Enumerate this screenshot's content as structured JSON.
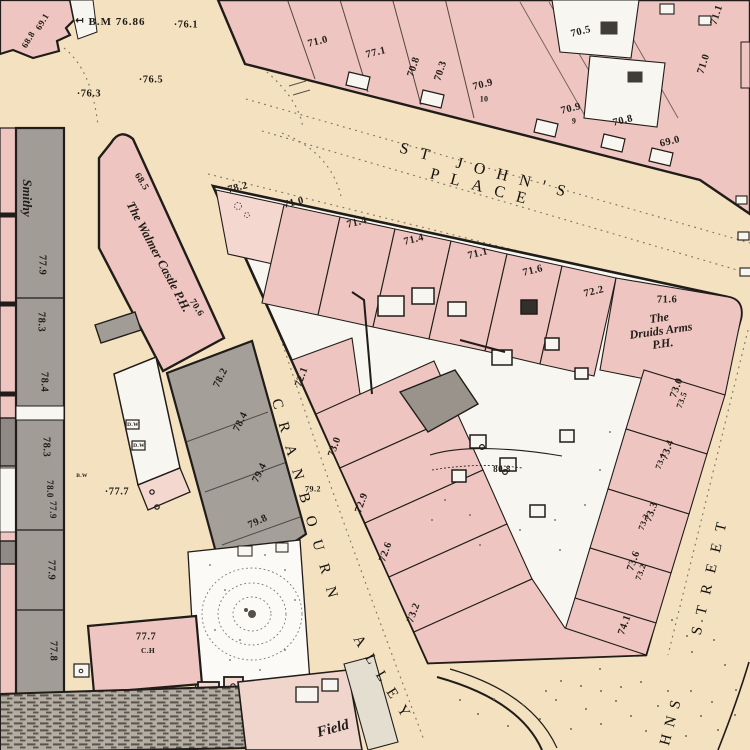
{
  "palette": {
    "street_tan": "#f3e1bf",
    "building_pink": "#eec5c0",
    "building_pink_light": "#f4d8d0",
    "yard_white": "#f8f6f0",
    "building_gray": "#a29c96",
    "building_gray_dark": "#8f8a85",
    "line_ink": "#201c19"
  },
  "streets": [
    {
      "t": "ST JOHN'S PLACE",
      "x": 486,
      "y": 180,
      "r": 15,
      "ls": 12,
      "n": "street-name-st-johns-place"
    },
    {
      "t": "CRANBOURN",
      "x": 306,
      "y": 505,
      "r": 74,
      "ls": 14,
      "s": 15,
      "n": "street-name-cranbourn"
    },
    {
      "t": "ALLEY",
      "x": 384,
      "y": 681,
      "r": 58,
      "ls": 11,
      "s": 15,
      "n": "street-name-alley"
    },
    {
      "t": "STREET",
      "x": 711,
      "y": 573,
      "r": -77,
      "ls": 12,
      "s": 15,
      "n": "street-name-street"
    },
    {
      "t": "HNS",
      "x": 672,
      "y": 719,
      "r": -75,
      "ls": 8,
      "s": 15,
      "n": "street-name-johns-partial"
    }
  ],
  "places": [
    {
      "t": "Smithy",
      "x": 27,
      "y": 198,
      "r": 90,
      "s": 13,
      "n": "place-name-smithy"
    },
    {
      "t": "The Walmer Castle P.H.",
      "x": 158,
      "y": 257,
      "r": 62,
      "s": 12.5,
      "n": "place-name-walmer-castle"
    },
    {
      "t": "The\nDruids Arms\nP.H.",
      "x": 661,
      "y": 331,
      "r": -8,
      "s": 12,
      "n": "place-name-druids-arms"
    },
    {
      "t": "Field",
      "x": 333,
      "y": 729,
      "r": -15,
      "s": 15,
      "n": "place-name-field"
    }
  ],
  "benchmarks": [
    {
      "t": "↤",
      "x": 80,
      "y": 22,
      "s": 10,
      "n": "benchmark-arrow"
    },
    {
      "t": "B.M 76.86",
      "x": 117,
      "y": 23,
      "n": "benchmark-value"
    }
  ],
  "spot_heights": [
    {
      "t": "69.1",
      "x": 43,
      "y": 22,
      "r": -60,
      "s": 9
    },
    {
      "t": "68.8",
      "x": 29,
      "y": 40,
      "r": -60,
      "s": 9
    },
    {
      "t": "·76.1",
      "x": 186,
      "y": 25
    },
    {
      "t": "·76.5",
      "x": 151,
      "y": 80
    },
    {
      "t": "·76.3",
      "x": 89,
      "y": 94
    },
    {
      "t": "71.0",
      "x": 318,
      "y": 42,
      "r": -14
    },
    {
      "t": "77.1",
      "x": 376,
      "y": 53,
      "r": -14
    },
    {
      "t": "70.8",
      "x": 414,
      "y": 67,
      "r": -72
    },
    {
      "t": "70.3",
      "x": 441,
      "y": 71,
      "r": -72
    },
    {
      "t": "70.9",
      "x": 483,
      "y": 85,
      "r": -14
    },
    {
      "t": "70.5",
      "x": 581,
      "y": 32,
      "r": -14
    },
    {
      "t": "70.9",
      "x": 571,
      "y": 109,
      "r": -14
    },
    {
      "t": "70.8",
      "x": 623,
      "y": 121,
      "r": -14
    },
    {
      "t": "69.0",
      "x": 670,
      "y": 142,
      "r": -14
    },
    {
      "t": "71.1",
      "x": 717,
      "y": 15,
      "r": -72
    },
    {
      "t": "71.0",
      "x": 704,
      "y": 64,
      "r": -72
    },
    {
      "t": "78.2",
      "x": 238,
      "y": 188,
      "r": -14
    },
    {
      "t": "71.0",
      "x": 294,
      "y": 203,
      "r": -14
    },
    {
      "t": "71.4",
      "x": 357,
      "y": 223,
      "r": -14
    },
    {
      "t": "71.4",
      "x": 414,
      "y": 240,
      "r": -14
    },
    {
      "t": "71.1",
      "x": 478,
      "y": 254,
      "r": -14
    },
    {
      "t": "71.6",
      "x": 533,
      "y": 271,
      "r": -14
    },
    {
      "t": "72.2",
      "x": 594,
      "y": 292,
      "r": -14
    },
    {
      "t": "71.6",
      "x": 667,
      "y": 300
    },
    {
      "t": "77.9",
      "x": 42,
      "y": 265,
      "r": 90
    },
    {
      "t": "78.3",
      "x": 41,
      "y": 322,
      "r": 90
    },
    {
      "t": "78.4",
      "x": 44,
      "y": 382,
      "r": 90
    },
    {
      "t": "78.3",
      "x": 46,
      "y": 447,
      "r": 90
    },
    {
      "t": "78.0",
      "x": 49,
      "y": 489,
      "r": 90,
      "s": 9
    },
    {
      "t": "77.9",
      "x": 52,
      "y": 510,
      "r": 90,
      "s": 9
    },
    {
      "t": "77.9",
      "x": 51,
      "y": 570,
      "r": 90
    },
    {
      "t": "77.8",
      "x": 53,
      "y": 651,
      "r": 90
    },
    {
      "t": "68.5",
      "x": 141,
      "y": 182,
      "r": 58,
      "s": 9.5
    },
    {
      "t": "70.6",
      "x": 196,
      "y": 308,
      "r": 58,
      "s": 9.5
    },
    {
      "t": "·77.7",
      "x": 117,
      "y": 492
    },
    {
      "t": "78.2",
      "x": 221,
      "y": 378,
      "r": -64
    },
    {
      "t": "78.4",
      "x": 241,
      "y": 422,
      "r": -64
    },
    {
      "t": "79.4",
      "x": 260,
      "y": 473,
      "r": -64
    },
    {
      "t": "79.8",
      "x": 258,
      "y": 522,
      "r": -25
    },
    {
      "t": "72.1",
      "x": 302,
      "y": 377,
      "r": -70
    },
    {
      "t": "73.0",
      "x": 335,
      "y": 447,
      "r": -70
    },
    {
      "t": "79.2",
      "x": 313,
      "y": 490,
      "s": 8
    },
    {
      "t": "72.9",
      "x": 362,
      "y": 503,
      "r": -70
    },
    {
      "t": "72.6",
      "x": 386,
      "y": 552,
      "r": -70
    },
    {
      "t": "73.2",
      "x": 414,
      "y": 613,
      "r": -70
    },
    {
      "t": "80.8",
      "x": 502,
      "y": 470,
      "s": 9
    },
    {
      "t": "73.0",
      "x": 677,
      "y": 388,
      "r": -70
    },
    {
      "t": "73.5",
      "x": 682,
      "y": 400,
      "r": -70,
      "s": 8.5
    },
    {
      "t": "73.4",
      "x": 668,
      "y": 450,
      "r": -70
    },
    {
      "t": "73.1",
      "x": 661,
      "y": 461,
      "r": -70,
      "s": 8.5
    },
    {
      "t": "73.3",
      "x": 652,
      "y": 512,
      "r": -70
    },
    {
      "t": "73.3",
      "x": 644,
      "y": 522,
      "r": -70,
      "s": 8.5
    },
    {
      "t": "73.6",
      "x": 634,
      "y": 561,
      "r": -70
    },
    {
      "t": "73.2",
      "x": 641,
      "y": 572,
      "r": -70,
      "s": 8.5
    },
    {
      "t": "74.1",
      "x": 625,
      "y": 625,
      "r": -70
    },
    {
      "t": "77.7",
      "x": 146,
      "y": 637
    }
  ],
  "notes": [
    {
      "t": "10",
      "x": 484,
      "y": 100,
      "s": 8,
      "n": "house-number"
    },
    {
      "t": "9",
      "x": 574,
      "y": 122,
      "s": 8,
      "n": "house-number"
    },
    {
      "t": "C.H",
      "x": 148,
      "y": 651,
      "s": 7.5,
      "n": "abbreviation-ch"
    },
    {
      "t": "B.W",
      "x": 82,
      "y": 477,
      "n": "abbreviation-bw"
    },
    {
      "t": "D.W",
      "x": 133,
      "y": 426,
      "n": "abbreviation-dw"
    },
    {
      "t": "D.W",
      "x": 139,
      "y": 447,
      "n": "abbreviation-dw"
    }
  ]
}
